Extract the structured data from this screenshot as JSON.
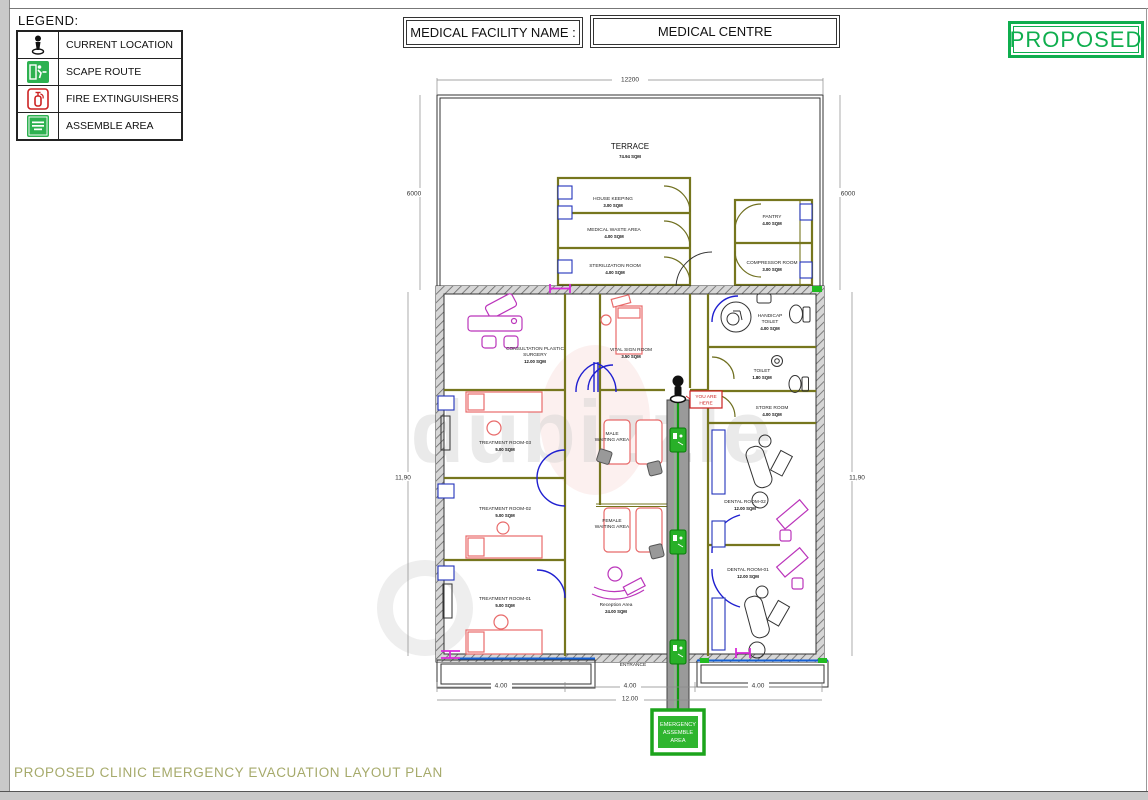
{
  "header": {
    "facility_label": "MEDICAL FACILITY NAME :",
    "facility_name": "MEDICAL CENTRE",
    "status_badge": "PROPOSED"
  },
  "legend": {
    "title": "LEGEND:",
    "items": [
      {
        "icon": "current-location-icon",
        "label": "CURRENT LOCATION"
      },
      {
        "icon": "scape-route-icon",
        "label": "SCAPE ROUTE"
      },
      {
        "icon": "fire-extinguisher-icon",
        "label": "FIRE EXTINGUISHERS"
      },
      {
        "icon": "assemble-area-icon",
        "label": "ASSEMBLE AREA"
      }
    ]
  },
  "plan": {
    "rooms": [
      {
        "name": "TERRACE",
        "sqm": "74.94 SQM"
      },
      {
        "name": "HOUSE KEEPING",
        "sqm": "3.00 SQM"
      },
      {
        "name": "MEDICAL WASTE AREA",
        "sqm": "4.00 SQM"
      },
      {
        "name": "STERILIZATION ROOM",
        "sqm": "4.00 SQM"
      },
      {
        "name": "PANTRY",
        "sqm": "4.00 SQM"
      },
      {
        "name": "COMPRESSOR ROOM",
        "sqm": "3.00 SQM"
      },
      {
        "name": "CONSULTATION PLASTIC",
        "name2": "SURGERY",
        "sqm": "12.00 SQM"
      },
      {
        "name": "VITAL SIGN ROOM",
        "sqm": "3.50 SQM"
      },
      {
        "name": "HANDICAP",
        "name2": "TOILET",
        "sqm": "4.00 SQM"
      },
      {
        "name": "TOILET",
        "sqm": "1.80 SQM"
      },
      {
        "name": "STORE ROOM",
        "sqm": "4.00 SQM"
      },
      {
        "name": "TREATMENT ROOM-03",
        "sqm": "5.00 SQM"
      },
      {
        "name": "TREATMENT ROOM-02",
        "sqm": "5.00 SQM"
      },
      {
        "name": "TREATMENT ROOM-01",
        "sqm": "5.00 SQM"
      },
      {
        "name": "MALE",
        "name2": "WAITING AREA"
      },
      {
        "name": "FEMALE",
        "name2": "WAITING AREA"
      },
      {
        "name": "DENTAL ROOM-02",
        "sqm": "12.00 SQM"
      },
      {
        "name": "DENTAL ROOM-01",
        "sqm": "12.00 SQM"
      },
      {
        "name": "Reception Area",
        "sqm": "24.00 SQM"
      }
    ],
    "labels": {
      "entrance": "ENTRANCE",
      "you_are_here_line1": "YOU ARE",
      "you_are_here_line2": "HERE",
      "assemble_line1": "EMERGENCY",
      "assemble_line2": "ASSEMBLE",
      "assemble_line3": "AREA"
    },
    "dimensions": {
      "top_width": "12200",
      "upper_height_left": "6000",
      "upper_height_right": "6000",
      "lower_height_left": "11,90",
      "lower_height_right": "11,90",
      "bottom_segments": [
        "4.00",
        "4.00",
        "4.00"
      ],
      "bottom_total": "12.00"
    }
  },
  "footer": {
    "title": "PROPOSED CLINIC EMERGENCY EVACUATION LAYOUT PLAN"
  },
  "watermark": "dubizzle",
  "colors": {
    "accent_green": "#0fae4e",
    "wall_olive": "#76761e",
    "door_blue": "#1f1fd0",
    "furniture_red": "#e86a6a",
    "furniture_magenta": "#bb35bb",
    "corridor_gray": "#9a9a9a",
    "marker_red": "#cc2222",
    "footer_olive": "#a6aa6b"
  }
}
